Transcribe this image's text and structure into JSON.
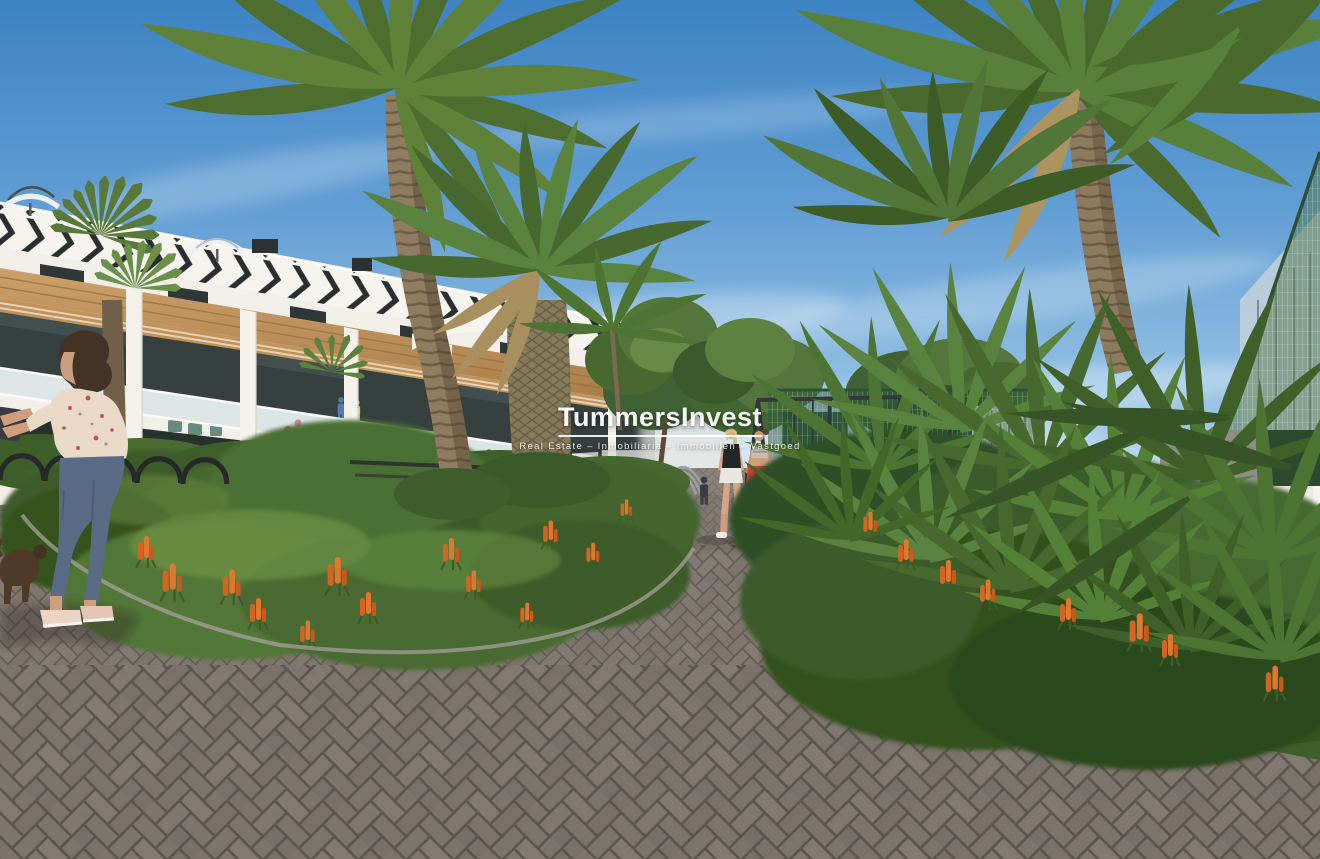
{
  "watermark": {
    "brand": "TummersInvest",
    "tagline": "Real Estate – Inmobiliaria – Immobilien – Vastgoed"
  },
  "scene": {
    "type": "architectural-rendering",
    "palette": {
      "sky_top": "#3d83c4",
      "sky_horizon": "#c9dfee",
      "building_white": "#f2efe9",
      "facade_stripe_black": "#2b2e2f",
      "wood_accent": "#c0925a",
      "foliage_dark": "#35521f",
      "foliage_light": "#6d9346",
      "palm_green": "#5d7c35",
      "flower_orange": "#d4641f",
      "paving_brick": "#7e766e",
      "paving_joint": "#59524b",
      "fence_green": "#2e5a3a",
      "wall_white": "#eceae6",
      "red_shorts": "#d23c2e",
      "denim_blue": "#5a6c85"
    },
    "elements": [
      "sky",
      "clouds",
      "apartment-building",
      "rooftop-umbrellas",
      "palm-trees",
      "garden-beds",
      "orange-flower-spikes",
      "playground",
      "sports-court-fence",
      "walking-path",
      "herringbone-paving",
      "pedestrians",
      "foreground-woman",
      "bike-racks",
      "boundary-wall",
      "mesh-fence"
    ]
  }
}
